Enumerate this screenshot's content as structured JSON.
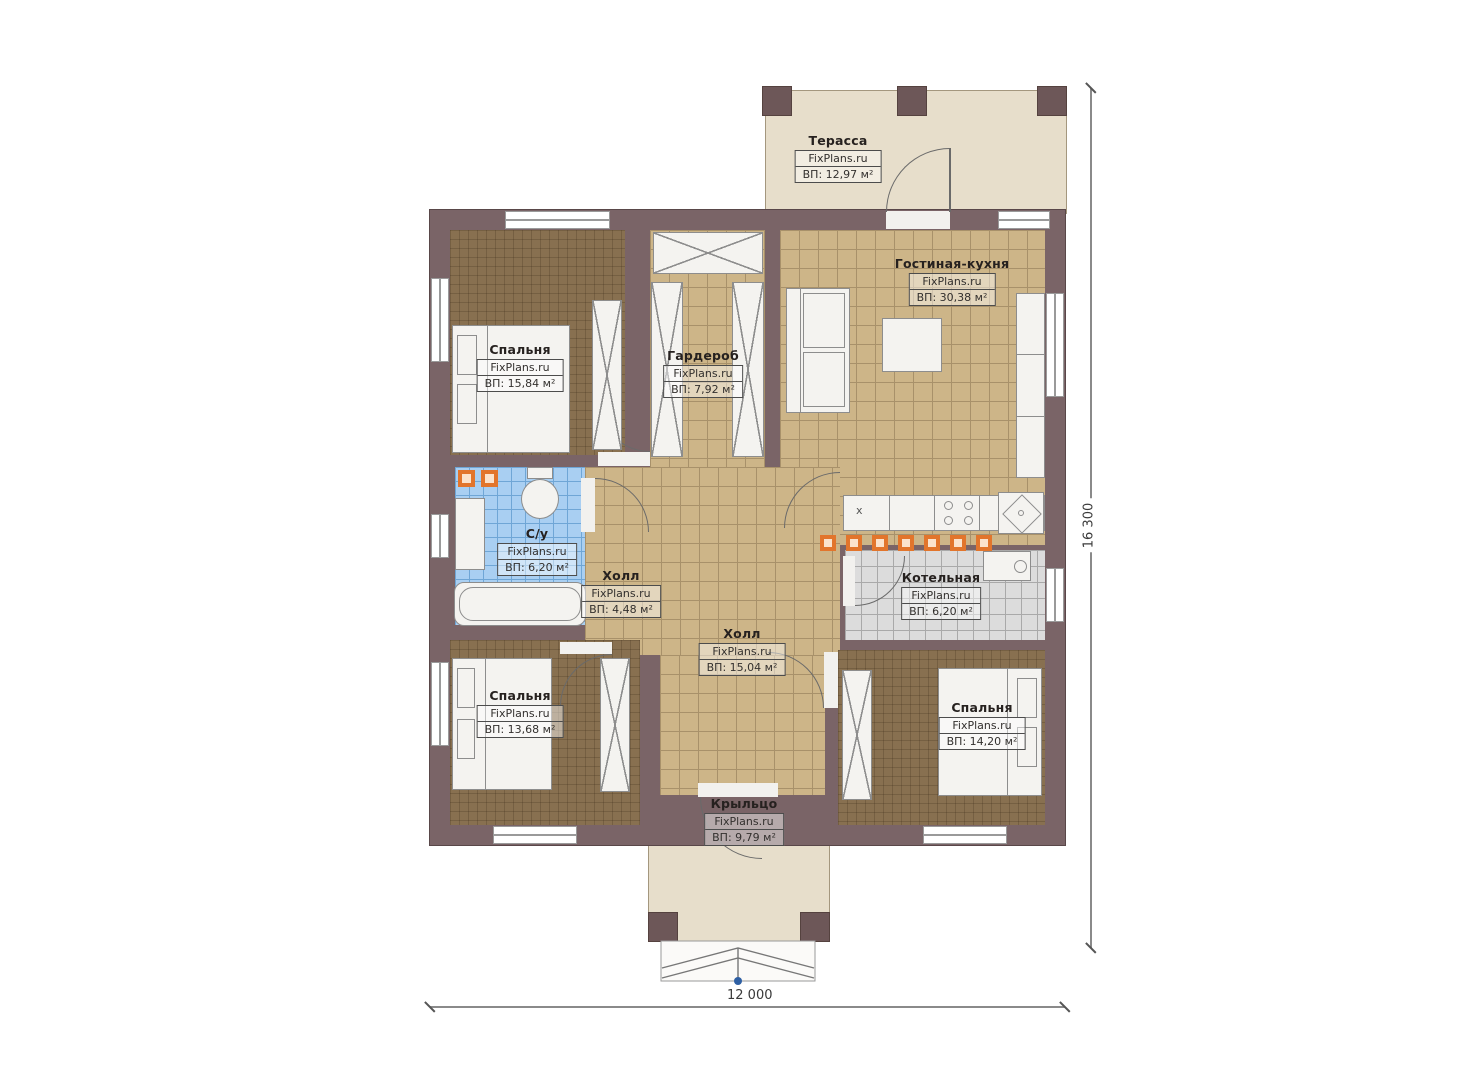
{
  "plan": {
    "title": "План одноэтажного дома",
    "rooms": [
      {
        "name": "Терасса",
        "watermark": "FixPlans.ru",
        "area": "ВП: 12,97 м²"
      },
      {
        "name": "Гостиная-кухня",
        "watermark": "FixPlans.ru",
        "area": "ВП: 30,38 м²"
      },
      {
        "name": "Спальня",
        "watermark": "FixPlans.ru",
        "area": "ВП: 15,84 м²"
      },
      {
        "name": "Гардероб",
        "watermark": "FixPlans.ru",
        "area": "ВП: 7,92 м²"
      },
      {
        "name": "С/у",
        "watermark": "FixPlans.ru",
        "area": "ВП: 6,20 м²"
      },
      {
        "name": "Холл",
        "watermark": "FixPlans.ru",
        "area": "ВП: 4,48 м²"
      },
      {
        "name": "Котельная",
        "watermark": "FixPlans.ru",
        "area": "ВП: 6,20 м²"
      },
      {
        "name": "Холл",
        "watermark": "FixPlans.ru",
        "area": "ВП: 15,04 м²"
      },
      {
        "name": "Спальня",
        "watermark": "FixPlans.ru",
        "area": "ВП: 13,68 м²"
      },
      {
        "name": "Спальня",
        "watermark": "FixPlans.ru",
        "area": "ВП: 14,20 м²"
      },
      {
        "name": "Крыльцо",
        "watermark": "FixPlans.ru",
        "area": "ВП: 9,79 м²"
      }
    ],
    "dimensions": {
      "width": "12 000",
      "height": "16 300"
    },
    "kitchen_cell_mark": "x",
    "colors": {
      "wall": "#7a6467",
      "tile_tan": "#cdb588",
      "carpet_brown": "#887050",
      "tile_blue": "#a9cff2",
      "tile_gray": "#dcdcdc",
      "outdoor_slab": "#e7decb",
      "accent_orange": "#e2752c"
    }
  }
}
